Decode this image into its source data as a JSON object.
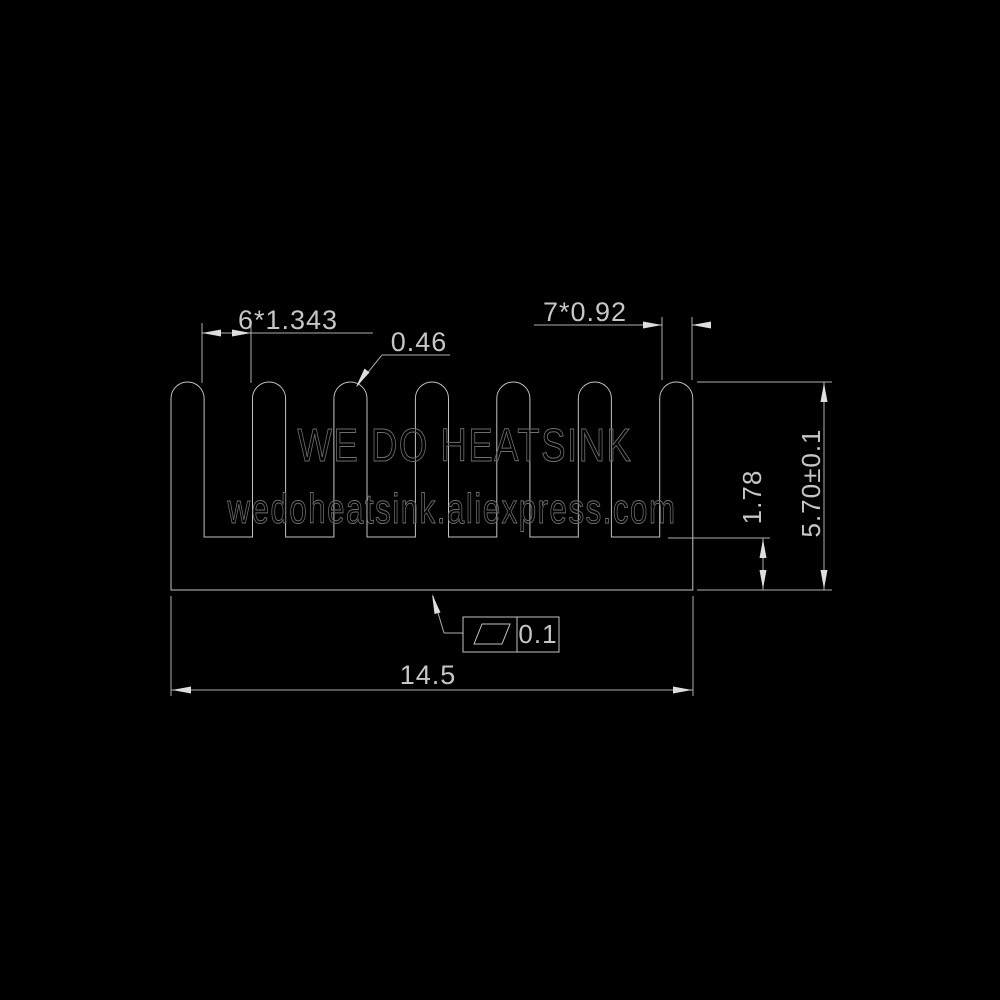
{
  "page": {
    "background": "#000000"
  },
  "drawing": {
    "type": "heatsink-cross-section-technical-drawing",
    "watermarks": {
      "brand": "WE DO HEATSINK",
      "url": "wedoheatsink.aliexpress.com"
    },
    "dimensions": {
      "fin_gap": "6*1.343",
      "fin_tip_radius": "0.46",
      "fin_thickness": "7*0.92",
      "base_thickness": "1.78",
      "overall_height": "5.70±0.1",
      "overall_width": "14.5"
    },
    "tolerance_frame": {
      "symbol": "flatness-parallelogram",
      "value": "0.1"
    },
    "colors": {
      "background": "#000000",
      "line": "#c2c2c2",
      "text": "#c6c6c6",
      "arrow": "#dedede",
      "watermark_stroke": "#6e6e6e"
    }
  }
}
